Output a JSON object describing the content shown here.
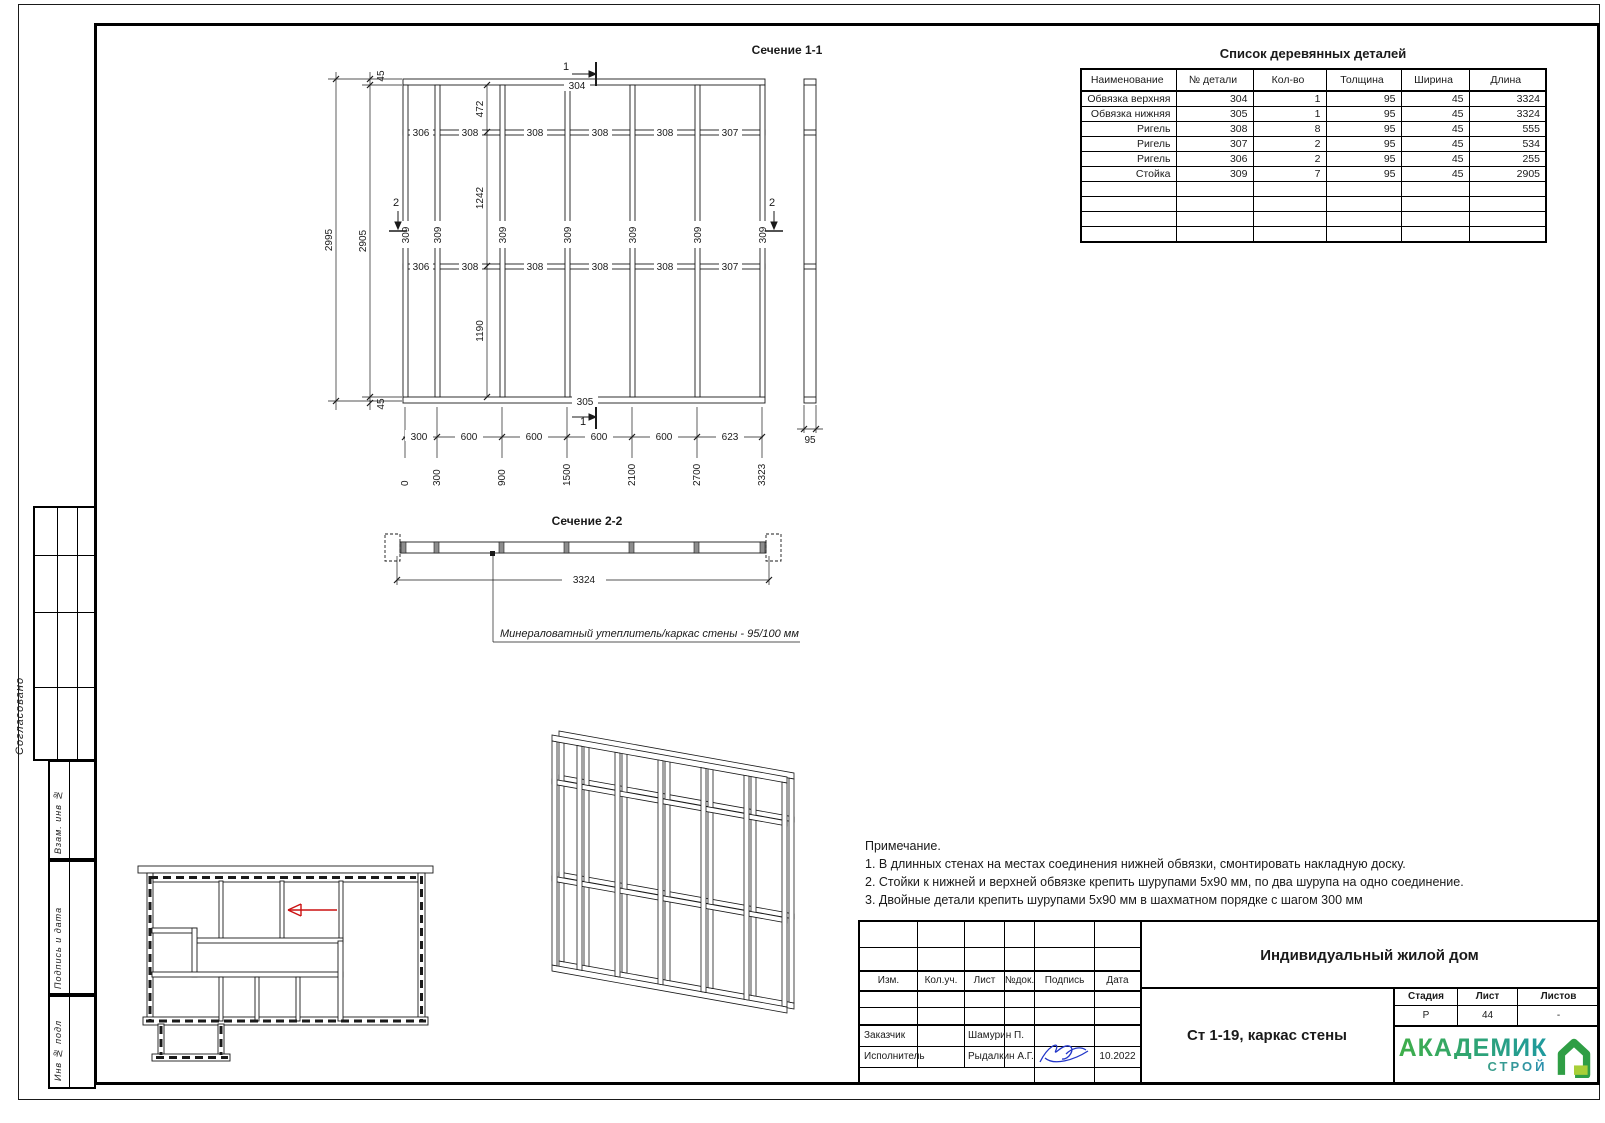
{
  "sidebar": {
    "approved": "Согласовано",
    "labels": [
      "Взам. инв №",
      "Подпись и дата",
      "Инв № подл"
    ]
  },
  "parts_table": {
    "title": "Список деревянных деталей",
    "headers": [
      "Наименование",
      "№ детали",
      "Кол-во",
      "Толщина",
      "Ширина",
      "Длина"
    ],
    "rows": [
      [
        "Обвязка верхняя",
        "304",
        "1",
        "95",
        "45",
        "3324"
      ],
      [
        "Обвязка нижняя",
        "305",
        "1",
        "95",
        "45",
        "3324"
      ],
      [
        "Ригель",
        "308",
        "8",
        "95",
        "45",
        "555"
      ],
      [
        "Ригель",
        "307",
        "2",
        "95",
        "45",
        "534"
      ],
      [
        "Ригель",
        "306",
        "2",
        "95",
        "45",
        "255"
      ],
      [
        "Стойка",
        "309",
        "7",
        "95",
        "45",
        "2905"
      ]
    ]
  },
  "section1": {
    "title": "Сечение 1-1",
    "plate_top": "304",
    "plate_bottom": "305",
    "marker1": "1",
    "marker2": "2",
    "stud_label": "309",
    "rails1": [
      "306",
      "308",
      "308",
      "308",
      "308",
      "307"
    ],
    "rails2": [
      "306",
      "308",
      "308",
      "308",
      "308",
      "307"
    ],
    "dims": {
      "total": "2995",
      "inner": "2905",
      "plate_top": "45",
      "plate_bottom": "45",
      "d472": "472",
      "d1242": "1242",
      "d1190": "1190",
      "side_width": "95",
      "bottom": [
        "300",
        "600",
        "600",
        "600",
        "600",
        "623"
      ],
      "coords": [
        "0",
        "300",
        "900",
        "1500",
        "2100",
        "2700",
        "3323"
      ]
    }
  },
  "section2": {
    "title": "Сечение 2-2",
    "length": "3324",
    "note": "Минераловатный утеплитель/каркас стены  -  95/100 мм"
  },
  "notes": {
    "title": "Примечание.",
    "items": [
      "1. В длинных стенах на местах соединения нижней обвязки, смонтировать накладную доску.",
      "2. Стойки к нижней и верхней обвязке крепить шурупами  5х90 мм, по два шурупа на одно соединение.",
      "3. Двойные детали крепить шурупами 5х90 мм в шахматном порядке с шагом 300 мм"
    ]
  },
  "stamp": {
    "cols": [
      "Изм.",
      "Кол.уч.",
      "Лист",
      "№док.",
      "Подпись",
      "Дата"
    ],
    "customer_label": "Заказчик",
    "customer": "Шамурин П.",
    "executor_label": "Исполнитель",
    "executor": "Рыдалкин А.Г.",
    "date": "10.2022",
    "project": "Индивидуальный жилой дом",
    "object": "Ст 1-19, каркас стены",
    "stage_label": "Стадия",
    "stage": "Р",
    "sheet_label": "Лист",
    "sheet": "44",
    "sheets_label": "Листов",
    "sheets": "-",
    "logo_line1": "АКАДЕМИК",
    "logo_line2": "СТРОЙ"
  }
}
